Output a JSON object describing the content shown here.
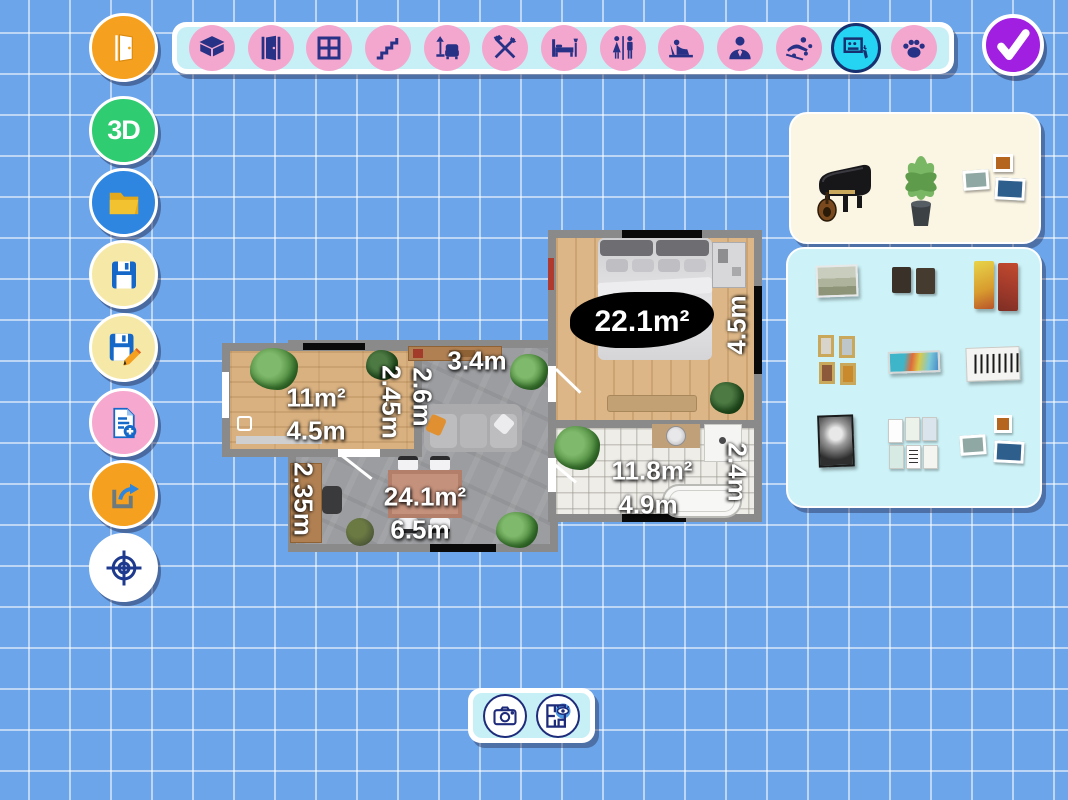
{
  "app": {
    "name": "floor-plan-editor"
  },
  "colors": {
    "background_blue": "#6CA5E9",
    "toolbar_cyan": "#C6F0F6",
    "category_pink": "#F4A7CE",
    "icon_navy": "#273185",
    "selected_cyan": "#25D4F2",
    "confirm_purple": "#A01FE0",
    "featured_panel_cream": "#FBF5E3",
    "catalog_panel_cyan": "#CDF3F8",
    "wall_gray": "#8A8A8A"
  },
  "top_toolbar": {
    "selected_category": "decor",
    "categories": [
      {
        "name": "rooms",
        "icon": "box-icon"
      },
      {
        "name": "doors",
        "icon": "door-icon"
      },
      {
        "name": "windows",
        "icon": "window-icon"
      },
      {
        "name": "stairs",
        "icon": "stairs-icon"
      },
      {
        "name": "living-furniture",
        "icon": "armchair-lamp-icon"
      },
      {
        "name": "kitchen",
        "icon": "cutlery-icon"
      },
      {
        "name": "bedroom-furniture",
        "icon": "bed-icon"
      },
      {
        "name": "bathroom",
        "icon": "wc-icon"
      },
      {
        "name": "kids",
        "icon": "child-lounge-icon"
      },
      {
        "name": "office",
        "icon": "person-icon"
      },
      {
        "name": "leisure",
        "icon": "swimmer-icon"
      },
      {
        "name": "decor",
        "icon": "picture-hand-icon"
      },
      {
        "name": "pets",
        "icon": "paw-icon"
      }
    ]
  },
  "confirm_button": {
    "icon": "check-icon"
  },
  "sidebar": {
    "buttons": [
      {
        "name": "exit",
        "icon": "door-open-icon",
        "color": "#F5A01E"
      },
      {
        "name": "view-3d",
        "label": "3D",
        "color": "#2FCC71"
      },
      {
        "name": "open-project",
        "icon": "folder-icon",
        "color": "#2F86E0"
      },
      {
        "name": "save",
        "icon": "floppy-icon",
        "color": "#F6E9A8"
      },
      {
        "name": "save-as",
        "icon": "floppy-pencil-icon",
        "color": "#F6E9A8"
      },
      {
        "name": "new-plan",
        "icon": "document-add-icon",
        "color": "#F7A8CF"
      },
      {
        "name": "export",
        "icon": "share-icon",
        "color": "#F5A01E"
      },
      {
        "name": "center-view",
        "icon": "crosshair-icon",
        "color": "#FFFFFF"
      }
    ]
  },
  "floorplan": {
    "rooms": [
      {
        "id": "bedroom",
        "area": "22.1m²",
        "side": "4.5m"
      },
      {
        "id": "room-2",
        "area": "11m²",
        "width": "4.5m",
        "side": "2.45m"
      },
      {
        "id": "living-room",
        "area": "24.1m²",
        "width": "6.5m",
        "side": "2.35m",
        "wall_a": "2.6m",
        "wall_b": "3.4m"
      },
      {
        "id": "bathroom",
        "area": "11.8m²",
        "width": "4.9m",
        "side": "2.4m"
      }
    ]
  },
  "catalog": {
    "featured": [
      {
        "name": "grand-piano"
      },
      {
        "name": "potted-plant"
      },
      {
        "name": "picture-set"
      }
    ],
    "items": [
      {
        "name": "landscape-painting"
      },
      {
        "name": "dark-panel-pair"
      },
      {
        "name": "abstract-panel-pair"
      },
      {
        "name": "gold-frame-set"
      },
      {
        "name": "panorama-picture"
      },
      {
        "name": "piano-keys-art"
      },
      {
        "name": "bw-portrait"
      },
      {
        "name": "white-frame-set"
      },
      {
        "name": "three-frame-set"
      }
    ]
  },
  "bottom_toolbar": {
    "buttons": [
      {
        "name": "screenshot",
        "icon": "camera-icon"
      },
      {
        "name": "plan-preview",
        "icon": "floorplan-eye-icon"
      }
    ]
  }
}
